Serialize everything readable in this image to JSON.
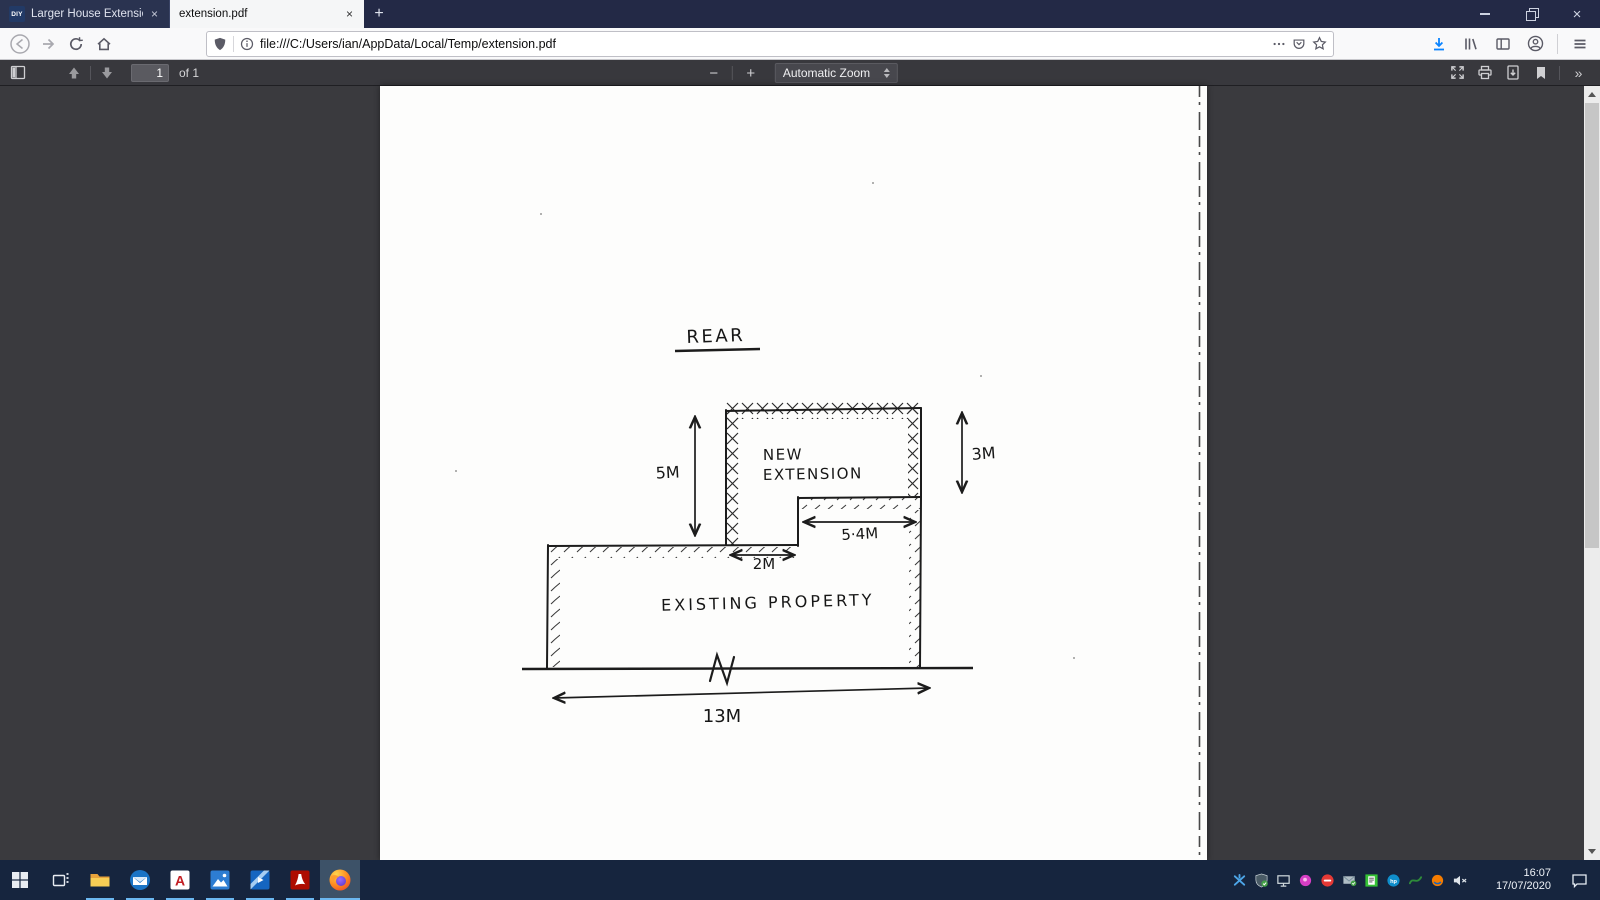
{
  "colors": {
    "titlebar_bg": "#232946",
    "tab_inactive_bg": "#2a3350",
    "active_tab_bg": "#f5f6f7",
    "navbar_bg": "#f9f9fa",
    "pdf_toolbar_bg": "#38383d",
    "viewport_bg": "#3a3a3e",
    "taskbar_bg": "#16253e",
    "accent_download": "#0a84ff",
    "running_underline": "#6cb8f0"
  },
  "titlebar": {
    "tabs": [
      {
        "favicon_label": "DIY",
        "title": "Larger House Extension Applica",
        "close_label": "×"
      },
      {
        "title": "extension.pdf",
        "close_label": "×"
      }
    ],
    "new_tab_label": "+"
  },
  "navbar": {
    "url": "file:///C:/Users/ian/AppData/Local/Temp/extension.pdf"
  },
  "pdf_toolbar": {
    "page_input_value": "1",
    "page_count_label": "of 1",
    "zoom_out_label": "−",
    "zoom_in_label": "+",
    "zoom_select_label": "Automatic Zoom",
    "more_tools_label": "»"
  },
  "sketch": {
    "title": "REAR",
    "new_extension_line1": "NEW",
    "new_extension_line2": "EXTENSION",
    "existing_label": "EXISTING PROPERTY",
    "dim_height_total": "5M",
    "dim_height_extension": "3M",
    "dim_width_extension": "5·4M",
    "dim_offset": "2M",
    "dim_width_total": "13M",
    "break_mark": "N"
  },
  "taskbar": {
    "app_icons": [
      "start",
      "task-view",
      "file-explorer",
      "thunderbird",
      "autocad",
      "photos",
      "movies-tv",
      "acrobat-reader",
      "firefox"
    ],
    "tray_icons": [
      "remote-access",
      "defender-shield",
      "network-display",
      "pink-app",
      "trend-antivirus",
      "mail-check",
      "print-queue",
      "hp",
      "green-swoosh",
      "orange-app",
      "volume-muted"
    ],
    "autocad_letter": "A",
    "hp_label": "hp",
    "clock": {
      "time": "16:07",
      "date": "17/07/2020"
    }
  }
}
